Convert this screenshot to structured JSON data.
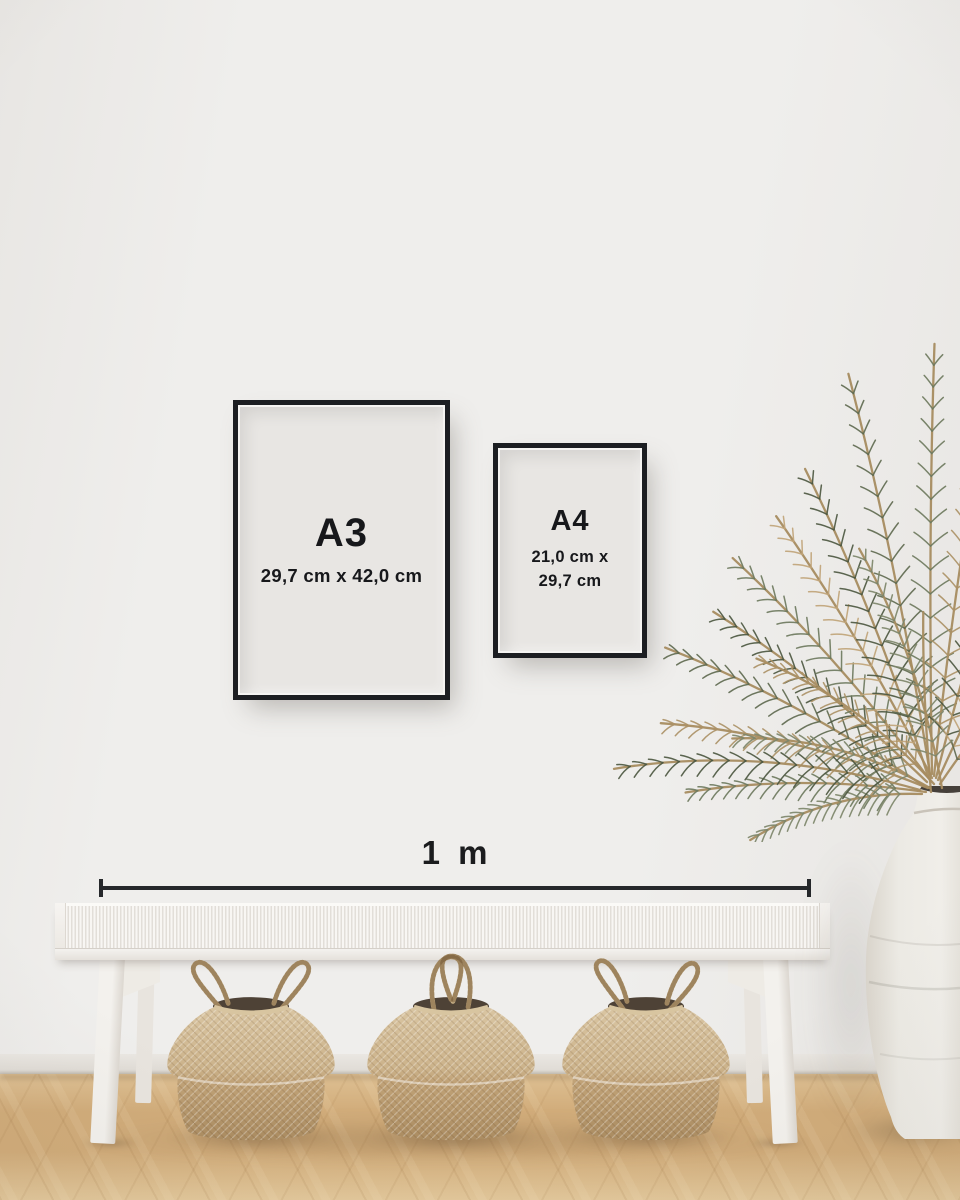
{
  "frames": {
    "a3": {
      "label": "A3",
      "dimensions": "29,7 cm x 42,0 cm"
    },
    "a4": {
      "label": "A4",
      "dimensions_line1": "21,0 cm x",
      "dimensions_line2": "29,7 cm"
    }
  },
  "scale_bar": {
    "label": "1 m"
  },
  "scene": {
    "colors": {
      "wall": "#efeeec",
      "wall_edge": "#e8e6e3",
      "paper": "#e8e6e3",
      "frame": "#1c1e22",
      "ink": "#17181b",
      "line": "#26282b",
      "floor_light": "#dec093",
      "floor_mid": "#d1ac7a",
      "floor_deep": "#e3c89b",
      "floor_grain": "#b78e5c",
      "baseboard": "#eae7e2",
      "baseboard_line": "#c9c4bc",
      "bench": "#f6f4f1",
      "bench_stripe": "#e2ded8",
      "bench_rail": "#f4f2ef",
      "bench_leg": "#f3f1ed",
      "bench_leg_back": "#e8e4de",
      "basket_light": "#d7c3a0",
      "basket_mid": "#c9b088",
      "basket_dark": "#ac8d62",
      "basket_inner": "#4e4236",
      "rope": "#c3ab82",
      "vase_light": "#efede8",
      "vase_shade": "#dcd7ce",
      "vase_rim": "#c9c3b9",
      "vase_mouth": "#46403a"
    },
    "basket_body": "M 61 22 C 36 33, 13 60, 12 81 C 11 88, 16 93, 23 96 C 21 113, 26 140, 34 153 C 52 165, 148 165, 166 153 C 174 140, 179 113, 177 96 C 184 93, 189 88, 188 81 C 187 60, 164 33, 139 22 Q 100 33, 61 22 Z",
    "basket_fold": "M 23 96 Q 100 111 177 96",
    "basket_rim_front": "M 61 22 Q 100 34 139 22",
    "baskets": [
      {
        "handle_left": "M 70 26 C 50 2, 32 -16, 42 -24 C 52 -31, 68 -8, 76 18",
        "handle_right": "M 130 26 C 150 2, 168 -16, 158 -24 C 148 -31, 132 -8, 124 18"
      },
      {
        "handle_left": "M 82 24 C 74 -16, 90 -35, 105 -30 C 115 -26, 110 -6, 102 16",
        "handle_right": "M 118 22 C 126 -18, 111 -36, 96 -31 C 86 -27, 92 -6, 100 14"
      },
      {
        "handle_left": "M 76 24 C 57 -2, 41 -19, 50 -26 C 60 -32, 74 -8, 80 16",
        "handle_right": "M 124 26 C 145 4, 161 -14, 152 -23 C 142 -30, 128 -6, 122 18"
      }
    ],
    "plant": {
      "stem": "#a78c60",
      "palette": [
        "#5f6a50",
        "#6e7a5e",
        "#4d5841",
        "#ab9166",
        "#c0a478",
        "#7d866a"
      ],
      "fronds": [
        {
          "x": 326,
          "y": 474,
          "angle": -172,
          "len": 238,
          "bend": -34,
          "leaf": 26,
          "c": 1
        },
        {
          "x": 328,
          "y": 470,
          "angle": -158,
          "len": 272,
          "bend": -40,
          "leaf": 30,
          "c": 3
        },
        {
          "x": 324,
          "y": 468,
          "angle": -146,
          "len": 292,
          "bend": -30,
          "leaf": 32,
          "c": 0
        },
        {
          "x": 327,
          "y": 464,
          "angle": -136,
          "len": 272,
          "bend": -26,
          "leaf": 32,
          "c": 2
        },
        {
          "x": 330,
          "y": 462,
          "angle": -127,
          "len": 296,
          "bend": -24,
          "leaf": 34,
          "c": 1
        },
        {
          "x": 332,
          "y": 460,
          "angle": -117,
          "len": 304,
          "bend": -20,
          "leaf": 34,
          "c": 4
        },
        {
          "x": 328,
          "y": 458,
          "angle": -108,
          "len": 330,
          "bend": -22,
          "leaf": 36,
          "c": 2
        },
        {
          "x": 330,
          "y": 456,
          "angle": -99,
          "len": 408,
          "bend": -18,
          "leaf": 36,
          "c": 0
        },
        {
          "x": 332,
          "y": 456,
          "angle": -91,
          "len": 430,
          "bend": 10,
          "leaf": 36,
          "c": 1
        },
        {
          "x": 334,
          "y": 458,
          "angle": -84,
          "len": 398,
          "bend": 16,
          "leaf": 34,
          "c": 3
        },
        {
          "x": 336,
          "y": 460,
          "angle": -76,
          "len": 340,
          "bend": 22,
          "leaf": 34,
          "c": 2
        },
        {
          "x": 338,
          "y": 462,
          "angle": -66,
          "len": 282,
          "bend": 26,
          "leaf": 32,
          "c": 4
        },
        {
          "x": 340,
          "y": 466,
          "angle": -56,
          "len": 230,
          "bend": 30,
          "leaf": 28,
          "c": 0
        },
        {
          "x": 322,
          "y": 476,
          "angle": -178,
          "len": 170,
          "bend": -52,
          "leaf": 22,
          "c": 5
        },
        {
          "x": 330,
          "y": 470,
          "angle": -150,
          "len": 196,
          "bend": -56,
          "leaf": 26,
          "c": 5
        },
        {
          "x": 334,
          "y": 466,
          "angle": -132,
          "len": 212,
          "bend": -48,
          "leaf": 28,
          "c": 3
        },
        {
          "x": 342,
          "y": 470,
          "angle": -100,
          "len": 250,
          "bend": -40,
          "leaf": 30,
          "c": 5
        },
        {
          "x": 320,
          "y": 472,
          "angle": -164,
          "len": 300,
          "bend": -64,
          "leaf": 30,
          "c": 2
        },
        {
          "x": 331,
          "y": 474,
          "angle": -95,
          "len": 180,
          "bend": 8,
          "leaf": 0,
          "c": 3
        }
      ]
    }
  }
}
